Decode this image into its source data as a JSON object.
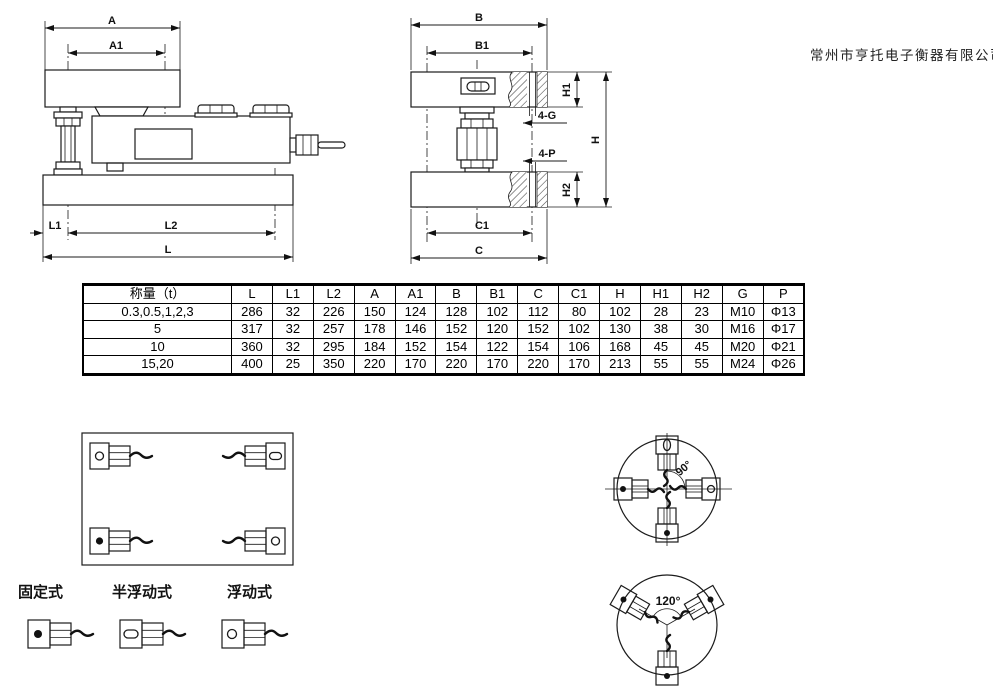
{
  "company_name": "常州市亨托电子衡器有限公司",
  "side_view": {
    "dims": {
      "a": "A",
      "a1": "A1",
      "l1": "L1",
      "l2": "L2",
      "l": "L"
    }
  },
  "front_view": {
    "dims": {
      "b": "B",
      "b1": "B1",
      "h1": "H1",
      "h": "H",
      "h2": "H2",
      "c1": "C1",
      "c": "C"
    },
    "hole_callouts": {
      "g": "4-G",
      "p": "4-P"
    }
  },
  "spec_table": {
    "headers": [
      "称量（t）",
      "L",
      "L1",
      "L2",
      "A",
      "A1",
      "B",
      "B1",
      "C",
      "C1",
      "H",
      "H1",
      "H2",
      "G",
      "P"
    ],
    "rows": [
      [
        "0.3,0.5,1,2,3",
        "286",
        "32",
        "226",
        "150",
        "124",
        "128",
        "102",
        "112",
        "80",
        "102",
        "28",
        "23",
        "M10",
        "Φ13"
      ],
      [
        "5",
        "317",
        "32",
        "257",
        "178",
        "146",
        "152",
        "120",
        "152",
        "102",
        "130",
        "38",
        "30",
        "M16",
        "Φ17"
      ],
      [
        "10",
        "360",
        "32",
        "295",
        "184",
        "152",
        "154",
        "122",
        "154",
        "106",
        "168",
        "45",
        "45",
        "M20",
        "Φ21"
      ],
      [
        "15,20",
        "400",
        "25",
        "350",
        "220",
        "170",
        "220",
        "170",
        "220",
        "170",
        "213",
        "55",
        "55",
        "M24",
        "Φ26"
      ]
    ]
  },
  "legend": {
    "items": [
      {
        "label": "固定式",
        "marker": "filled-dot-icon"
      },
      {
        "label": "半浮动式",
        "marker": "slot-oval-icon"
      },
      {
        "label": "浮动式",
        "marker": "open-circle-icon"
      }
    ]
  },
  "circle_layouts": {
    "four_cell_angle": "90°",
    "three_cell_angle": "120°"
  }
}
